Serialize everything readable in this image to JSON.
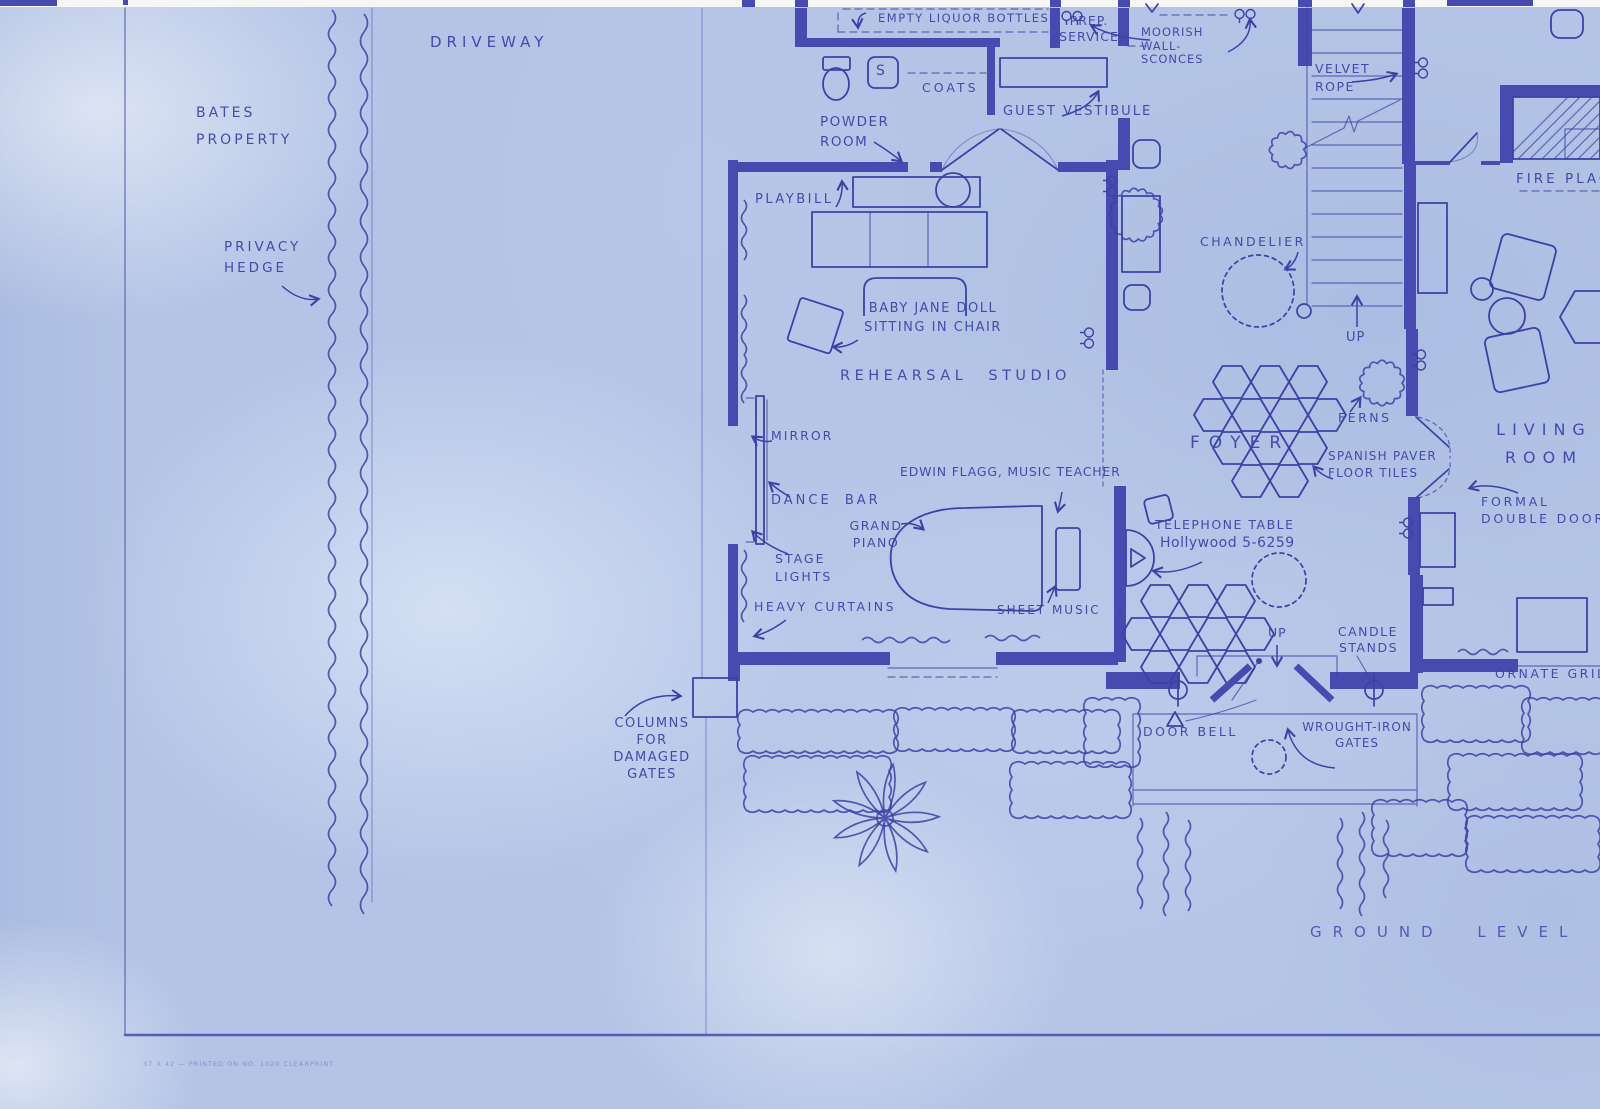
{
  "title": "Hand-drawn blueprint floor plan, ground level",
  "colors": {
    "paper": "#b3c4e6",
    "ink": "#3d41a6",
    "wall": "#474aae"
  },
  "labels": {
    "driveway": "DRIVEWAY",
    "bates_property": "BATES\nPROPERTY",
    "privacy_hedge": "PRIVACY\nHEDGE",
    "empty_liquor_bottles": "EMPTY LIQUOR BOTTLES",
    "prep_service": "PREP.\nSERVICE",
    "sink": "S",
    "coats": "COATS",
    "powder_room": "POWDER\nROOM",
    "guest_vestibule": "GUEST VESTIBULE",
    "moorish_wall_sconces": "MOORISH\nWALL-\nSCONCES",
    "velvet_rope": "VELVET\nROPE",
    "fireplace": "FIRE PLACE",
    "playbill": "PLAYBILL",
    "chandelier": "CHANDELIER",
    "up_stairs": "UP",
    "baby_jane_doll": "BABY JANE DOLL\nSITTING IN CHAIR",
    "rehearsal_studio": "REHEARSAL STUDIO",
    "mirror": "MIRROR",
    "dance_bar": "DANCE BAR",
    "stage_lights": "STAGE\nLIGHTS",
    "edwin_flagg": "EDWIN FLAGG, MUSIC TEACHER",
    "grand_piano": "GRAND\nPIANO",
    "sheet_music": "SHEET MUSIC",
    "heavy_curtains": "HEAVY CURTAINS",
    "telephone_table": "TELEPHONE TABLE",
    "telephone_number": "Hollywood 5-6259",
    "foyer": "FOYER",
    "ferns": "FERNS",
    "spanish_paver": "SPANISH PAVER\nFLOOR TILES",
    "living_room": "LIVING\nROOM",
    "formal_double_doors": "FORMAL\nDOUBLE DOORS",
    "up_entry": "UP",
    "candle_stands": "CANDLE\nSTANDS",
    "ornate_grille": "ORNATE GRILLE",
    "columns_for_damaged_gates": "COLUMNS\nFOR\nDAMAGED\nGATES",
    "door_bell": "DOOR BELL",
    "wrought_iron_gates": "WROUGHT-IRON\nGATES",
    "ground_level": "GROUND LEVEL",
    "print_line": "37 X 42 — PRINTED ON NO. 1020 CLEARPRINT"
  }
}
